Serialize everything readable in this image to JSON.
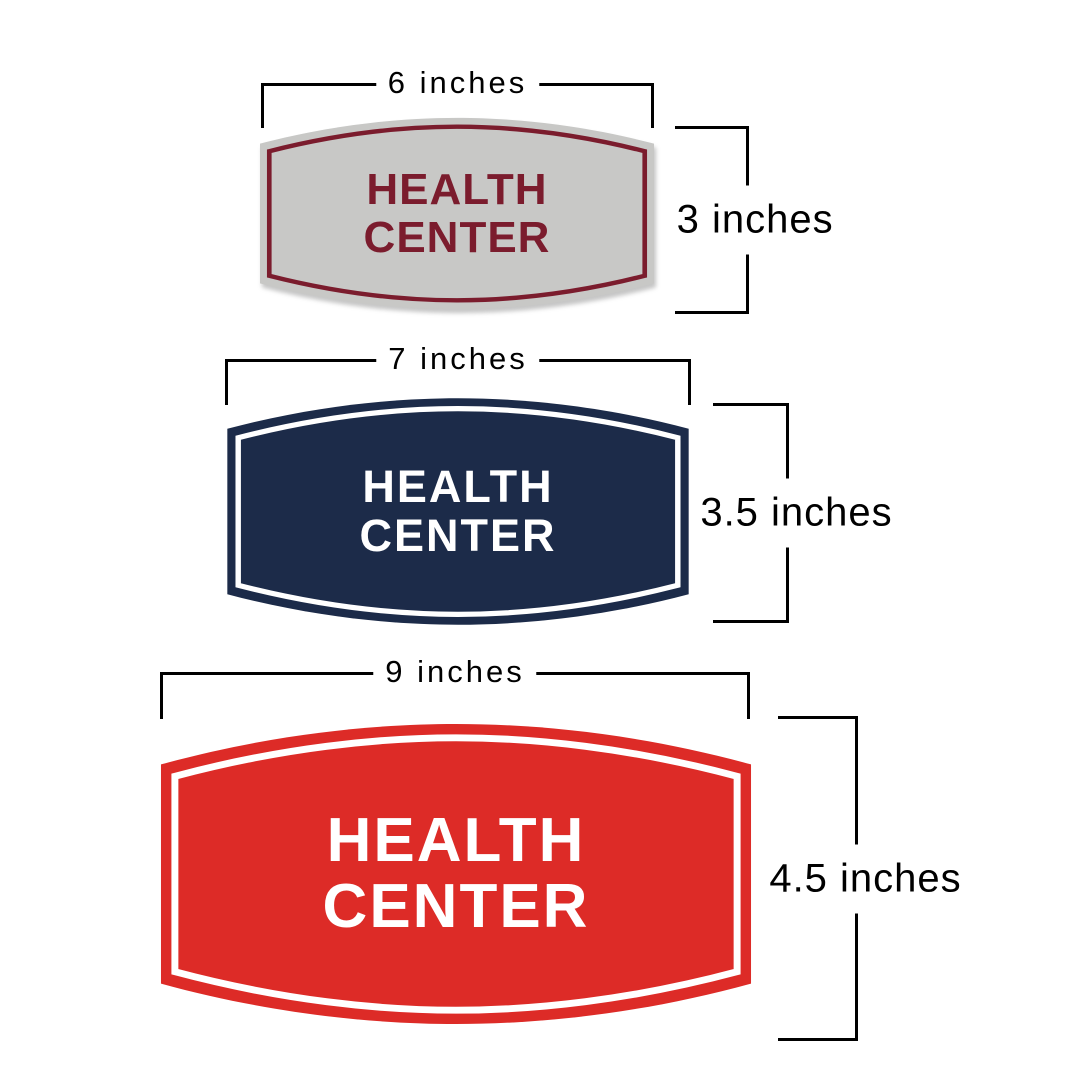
{
  "dimension_style": {
    "line_color": "#000000",
    "label_color": "#000000"
  },
  "signs": [
    {
      "label": {
        "line1": "HEALTH",
        "line2": "CENTER"
      },
      "width_label": "6 inches",
      "height_label": "3 inches",
      "colors": {
        "background": "#c8c8c6",
        "border": "#7b1c2d",
        "text": "#7b1c2d"
      }
    },
    {
      "label": {
        "line1": "HEALTH",
        "line2": "CENTER"
      },
      "width_label": "7 inches",
      "height_label": "3.5 inches",
      "colors": {
        "background": "#1c2b49",
        "border": "#ffffff",
        "text": "#ffffff"
      }
    },
    {
      "label": {
        "line1": "HEALTH",
        "line2": "CENTER"
      },
      "width_label": "9 inches",
      "height_label": "4.5 inches",
      "colors": {
        "background": "#dd2b27",
        "border": "#ffffff",
        "text": "#ffffff"
      }
    }
  ]
}
